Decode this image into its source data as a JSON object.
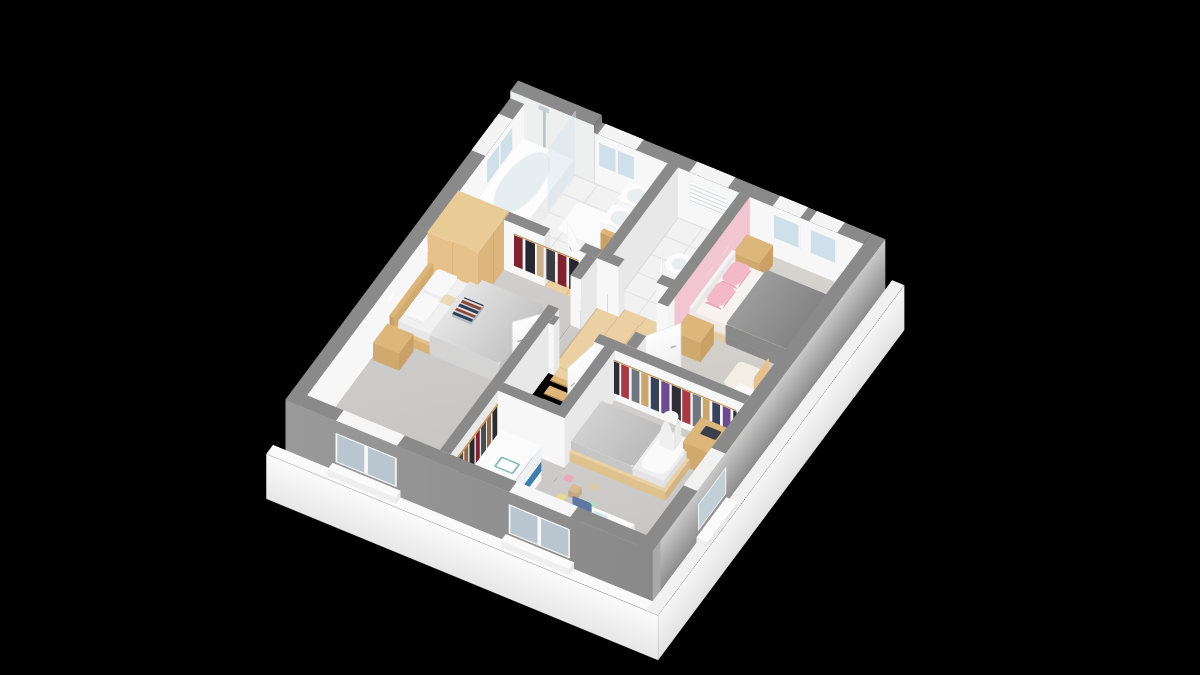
{
  "scene": {
    "type": "3d-floor-plan-render",
    "view": "isometric dollhouse cutaway, rotated diamond orientation",
    "background": "black",
    "walls": "gray cut tops, white interior faces, gray exterior faces on white foundation slab"
  },
  "colors": {
    "bg": "#000000",
    "wallTop": "#8a8a8a",
    "wallFace": "#f7f7f7",
    "wallFaceD": "#e8e8e8",
    "wallExt": "#8f8f8f",
    "wallExtD": "#a9a9a9",
    "slab": "#fafafa",
    "tile": "#f2f2f2",
    "grout": "#dfdfdf",
    "carpet": "#cbcac8",
    "carpetWarm": "#d3d0cc",
    "wood": "#ead0a2",
    "woodMid": "#ddb67c",
    "woodDark": "#c9a066",
    "white": "#f7f7f7",
    "mattress": "#efefef",
    "blanket": "#c7c7c7",
    "duvet": "#8f8f8f",
    "pinkWall": "#f2c5d3",
    "pinkTextile": "#f4b9c8",
    "glassC": "#cfe0ea",
    "steel": "#b9c2c6",
    "navy": "#31519e",
    "chairBlue": "#5e77a3",
    "drawerBlue": "#3f7fae",
    "green": "#5f9b52",
    "cream": "#f0e0d6"
  },
  "rooms": [
    {
      "id": "bathroom",
      "position": "north-west top",
      "floor": "white tile",
      "furniture": [
        "bathtub",
        "shower-glass-screen",
        "shower-column",
        "double-washbasin-vanity",
        "bath-mat",
        "plant"
      ]
    },
    {
      "id": "wc",
      "position": "north center",
      "floor": "white tile",
      "furniture": [
        "toilet",
        "shutter-window"
      ]
    },
    {
      "id": "bedroom-pink",
      "position": "east",
      "floor": "beige carpet",
      "accent": "pink west wall",
      "furniture": [
        "double-bed-gray-duvet",
        "pink-pillows",
        "nightstand-north",
        "nightstand-south",
        "wall-shelves",
        "wood-chair",
        "bookshelf"
      ]
    },
    {
      "id": "bedroom-master",
      "position": "west",
      "floor": "gray carpet",
      "furniture": [
        "double-bed-wood-frame",
        "book-stack",
        "nightstand-north",
        "nightstand-south",
        "wall-sconces",
        "wardrobe",
        "clothes-rack",
        "pouf"
      ]
    },
    {
      "id": "bedroom-kids",
      "position": "south-east",
      "floor": "gray carpet",
      "furniture": [
        "single-bed",
        "penguin-plush",
        "clothes-rail",
        "desk",
        "laptop",
        "floor-lamp",
        "toy-box",
        "kids-desk",
        "kids-chair",
        "toy-blocks"
      ]
    },
    {
      "id": "landing",
      "position": "center",
      "floor": "light wood",
      "furniture": [
        "staircase-down"
      ]
    },
    {
      "id": "dressing-nook",
      "position": "south-west center",
      "floor": "gray carpet",
      "furniture": [
        "clothes-rail",
        "white-dresser",
        "pink-watering-can",
        "drawing-board"
      ]
    }
  ],
  "openings": {
    "windows": [
      "bathroom-nw-window",
      "bathroom-ne-window",
      "wc-shutter-window",
      "pink-ne-window-1",
      "pink-ne-window-2",
      "master-sw-window",
      "kids-sw-window",
      "kids-se-window"
    ],
    "doors": [
      "bathroom-door",
      "wc-door",
      "pink-bedroom-door",
      "kids-bedroom-door",
      "master-bedroom-door"
    ]
  },
  "staircase": {
    "steps": 8,
    "material": "light wood",
    "descends": "toward south-west",
    "lower_floor_color": "cream"
  }
}
